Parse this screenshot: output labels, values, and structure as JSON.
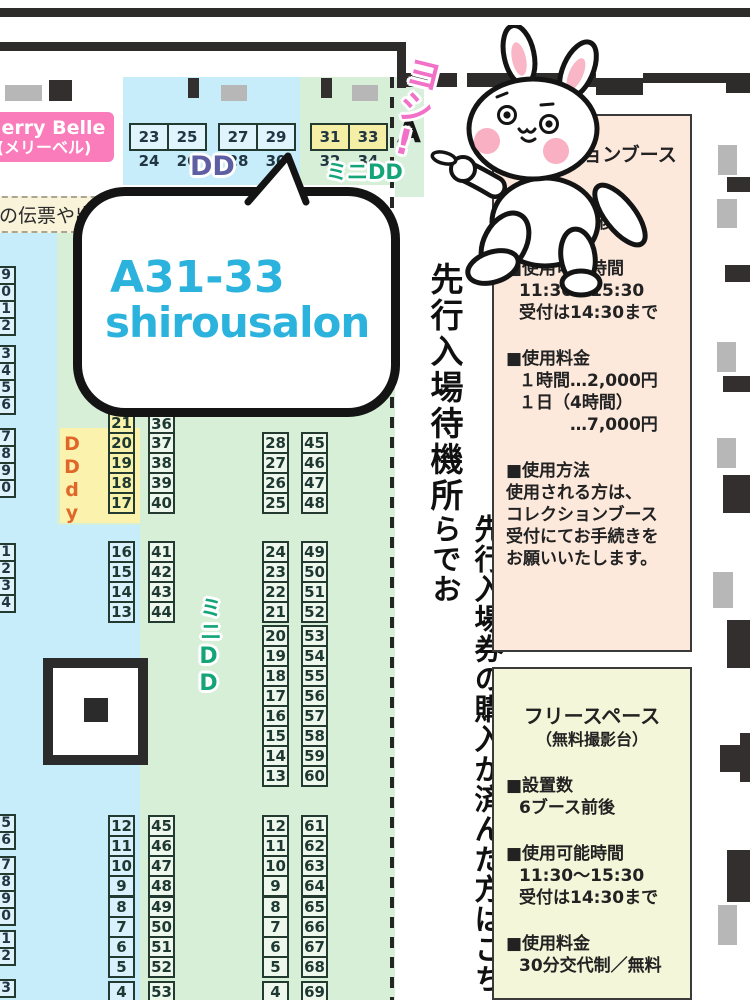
{
  "merry_belle": {
    "line1": "Merry Belle",
    "line2": "(メリーベル)"
  },
  "note_strip": {
    "text": "の伝票や出展"
  },
  "zones": {
    "dd_label": "DD",
    "mini_dd_label": "ミニDD",
    "mini_dd_vertical_label": "ミニDD",
    "ddy_label": "DDdy",
    "block_label": "A"
  },
  "mascot": {
    "exclamation": "ヨシ!"
  },
  "speech_bubble": {
    "line1": "A31-33",
    "line2": "shirousalon"
  },
  "waiting_area": {
    "title": "先行入場待機所",
    "description": "先行入場券の購入が済んだ方はこちらでお"
  },
  "top_strips": [
    {
      "x": 129,
      "y": 123,
      "zone": "dd",
      "cells": [
        "23 24",
        "25 26"
      ]
    },
    {
      "x": 218,
      "y": 123,
      "zone": "dd",
      "cells": [
        "27 28",
        "29 30"
      ]
    },
    {
      "x": 310,
      "y": 123,
      "zone": "mini",
      "cells": [
        "31 32",
        "33 34"
      ]
    }
  ],
  "booth_columns": [
    {
      "x": 108,
      "y": 412,
      "zone": "z-yellow",
      "cells": [
        "21"
      ]
    },
    {
      "x": 148,
      "y": 413,
      "zone": "z-green",
      "cells": [
        "36"
      ]
    },
    {
      "x": 108,
      "y": 432,
      "zone": "z-yellow",
      "cells": [
        "20",
        "19",
        "18",
        "17"
      ]
    },
    {
      "x": 148,
      "y": 432,
      "zone": "z-green",
      "cells": [
        "37",
        "38",
        "39",
        "40"
      ]
    },
    {
      "x": 262,
      "y": 432,
      "zone": "z-green",
      "cells": [
        "28",
        "27",
        "26",
        "25"
      ]
    },
    {
      "x": 301,
      "y": 432,
      "zone": "z-green",
      "cells": [
        "45",
        "46",
        "47",
        "48"
      ]
    },
    {
      "x": 108,
      "y": 541,
      "zone": "z-blue",
      "cells": [
        "16",
        "15",
        "14",
        "13"
      ]
    },
    {
      "x": 148,
      "y": 541,
      "zone": "z-green",
      "cells": [
        "41",
        "42",
        "43",
        "44"
      ]
    },
    {
      "x": 262,
      "y": 541,
      "zone": "z-green",
      "cells": [
        "24",
        "23",
        "22",
        "21"
      ]
    },
    {
      "x": 301,
      "y": 541,
      "zone": "z-green",
      "cells": [
        "49",
        "50",
        "51",
        "52"
      ]
    },
    {
      "x": 262,
      "y": 625,
      "zone": "z-green",
      "cells": [
        "20",
        "19",
        "18",
        "17"
      ]
    },
    {
      "x": 301,
      "y": 625,
      "zone": "z-green",
      "cells": [
        "53",
        "54",
        "55",
        "56"
      ]
    },
    {
      "x": 262,
      "y": 705,
      "zone": "z-green",
      "cells": [
        "16",
        "15",
        "14",
        "13"
      ]
    },
    {
      "x": 301,
      "y": 705,
      "zone": "z-green",
      "cells": [
        "57",
        "58",
        "59",
        "60"
      ]
    },
    {
      "x": 108,
      "y": 815,
      "zone": "z-blue",
      "cells": [
        "12",
        "11",
        "10",
        "9"
      ]
    },
    {
      "x": 148,
      "y": 815,
      "zone": "z-green",
      "cells": [
        "45",
        "46",
        "47",
        "48"
      ]
    },
    {
      "x": 262,
      "y": 815,
      "zone": "z-green",
      "cells": [
        "12",
        "11",
        "10",
        "9"
      ]
    },
    {
      "x": 301,
      "y": 815,
      "zone": "z-green",
      "cells": [
        "61",
        "62",
        "63",
        "64"
      ]
    },
    {
      "x": 108,
      "y": 896,
      "zone": "z-blue",
      "cells": [
        "8",
        "7",
        "6",
        "5"
      ]
    },
    {
      "x": 148,
      "y": 896,
      "zone": "z-green",
      "cells": [
        "49",
        "50",
        "51",
        "52"
      ]
    },
    {
      "x": 262,
      "y": 896,
      "zone": "z-green",
      "cells": [
        "8",
        "7",
        "6",
        "5"
      ]
    },
    {
      "x": 301,
      "y": 896,
      "zone": "z-green",
      "cells": [
        "65",
        "66",
        "67",
        "68"
      ]
    },
    {
      "x": 108,
      "y": 981,
      "zone": "z-blue",
      "cells": [
        "4"
      ]
    },
    {
      "x": 148,
      "y": 981,
      "zone": "z-green",
      "cells": [
        "53"
      ]
    },
    {
      "x": 262,
      "y": 981,
      "zone": "z-green",
      "cells": [
        "4"
      ]
    },
    {
      "x": 301,
      "y": 981,
      "zone": "z-green",
      "cells": [
        "69"
      ]
    }
  ],
  "edge_columns": [
    {
      "y": 266,
      "cells": [
        "9",
        "0",
        "1",
        "2"
      ]
    },
    {
      "y": 345,
      "cells": [
        "3",
        "4",
        "5",
        "6"
      ]
    },
    {
      "y": 428,
      "cells": [
        "7",
        "8",
        "9",
        "0"
      ]
    },
    {
      "y": 543,
      "cells": [
        "1",
        "2",
        "3",
        "4"
      ]
    },
    {
      "y": 814,
      "cells": [
        "5",
        "6"
      ]
    },
    {
      "y": 856,
      "cells": [
        "7",
        "8",
        "9",
        "0"
      ]
    },
    {
      "y": 930,
      "cells": [
        "1",
        "2"
      ]
    },
    {
      "y": 979,
      "cells": [
        "3"
      ]
    }
  ],
  "collection_panel": {
    "title": "コレクションブース",
    "sections": [
      {
        "heading": "■設置数",
        "lines": [
          "5ブース前後"
        ],
        "flush": false
      },
      {
        "heading": "■使用可能時間",
        "lines": [
          "11:30～15:30",
          "受付は14:30まで"
        ],
        "flush": false
      },
      {
        "heading": "■使用料金",
        "lines": [
          "１時間…2,000円",
          "１日（4時間）",
          "　　　…7,000円"
        ],
        "flush": false
      },
      {
        "heading": "■使用方法",
        "lines": [
          "使用される方は、",
          "コレクションブース",
          "受付にてお手続きを",
          "お願いいたします。"
        ],
        "flush": true
      }
    ]
  },
  "free_space_panel": {
    "title": "フリースペース",
    "subtitle": "（無料撮影台）",
    "sections": [
      {
        "heading": "■設置数",
        "lines": [
          "6ブース前後"
        ],
        "flush": false
      },
      {
        "heading": "■使用可能時間",
        "lines": [
          "11:30～15:30",
          "受付は14:30まで"
        ],
        "flush": false
      },
      {
        "heading": "■使用料金",
        "lines": [
          "30分交代制／無料"
        ],
        "flush": false
      }
    ]
  }
}
